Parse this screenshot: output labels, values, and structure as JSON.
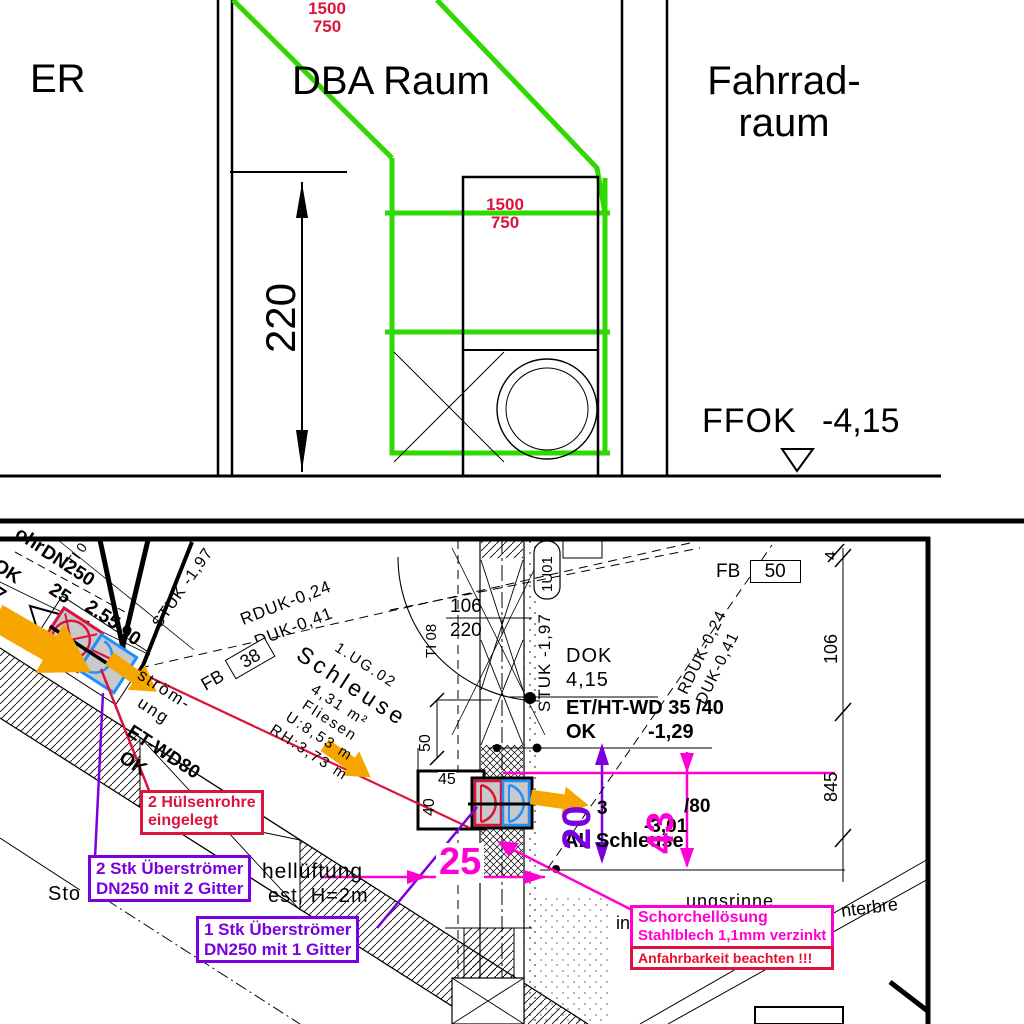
{
  "palette": {
    "green": "#2fd800",
    "crimson": "#dc143c",
    "magenta": "#ff00d2",
    "purple": "#7b00e0",
    "orange": "#f7a600",
    "blue": "#2090ff",
    "gray_fill": "#c9c9c9"
  },
  "top": {
    "er": "ER",
    "dba": "DBA Raum",
    "fahrrad1": "Fahrrad-",
    "fahrrad2": "raum",
    "dim_upper_w": "1500",
    "dim_upper_h": "750",
    "dim_lower_w": "1500",
    "dim_lower_h": "750",
    "height": "220",
    "level_name": "FFOK",
    "level_value": "-4,15"
  },
  "plan": {
    "room": {
      "lines": [
        "1.UG.02",
        "Schleuse",
        "4,31 m²",
        "Fliesen",
        "U:8,53 m",
        "RH:3,73 m"
      ]
    },
    "levels": {
      "rduk1": "RDUK-0,24",
      "duk1": "DUK-0,41",
      "rduk2": "RDUK-0,24",
      "duk2": "DUK-0,41",
      "stuk1": "STUK -1,97",
      "stuk2": "STUK -1,97",
      "dok": "DOK",
      "dokval": "4,15"
    },
    "tags": {
      "fb": "FB",
      "fb38": "38",
      "fb50": "50",
      "ti08": "TI 08",
      "d106": "106",
      "d220": "220",
      "room1u01": "1U01",
      "ti0": "TI 0"
    },
    "dims": {
      "p20": "20",
      "m43": "43",
      "m25": "25",
      "d50": "50",
      "d45": "45",
      "d40": "40",
      "d4": "4",
      "d106": "106",
      "d845": "845"
    },
    "bold": {
      "wd1": "ET/HT-WD 35 /40",
      "ok1": "OK",
      "v129": "-1,29",
      "three": "3",
      "v80": "/80",
      "v301": "-3,01",
      "al": "AL Schleuse",
      "etwd80": "ET-WD80",
      "ok2": "OK"
    },
    "frags": {
      "ohr": "ohr",
      "dn250": "DN250",
      "n25": "25",
      "ok": "OK",
      "seven": "7",
      "v255": "2.55",
      "v90": "90",
      "stroem": "ström-",
      "ung": "ung",
      "sto": "Sto",
      "lueftung": "hellüftung",
      "h2m": "est, H=2m",
      "rinne": "ungsrinne",
      "infrag": "in",
      "unterbre": "nterbre"
    },
    "call": {
      "h1": "2 Hülsenrohre",
      "h2": "eingelegt",
      "u21": "2 Stk Überströmer",
      "u22": "DN250 mit 2 Gitter",
      "u11": "1 Stk Überströmer",
      "u12": "DN250 mit 1 Gitter",
      "s1": "Schorchellösung",
      "s2": "Stahlblech 1,1mm verzinkt",
      "anf": "Anfahrbarkeit beachten !!!"
    }
  }
}
